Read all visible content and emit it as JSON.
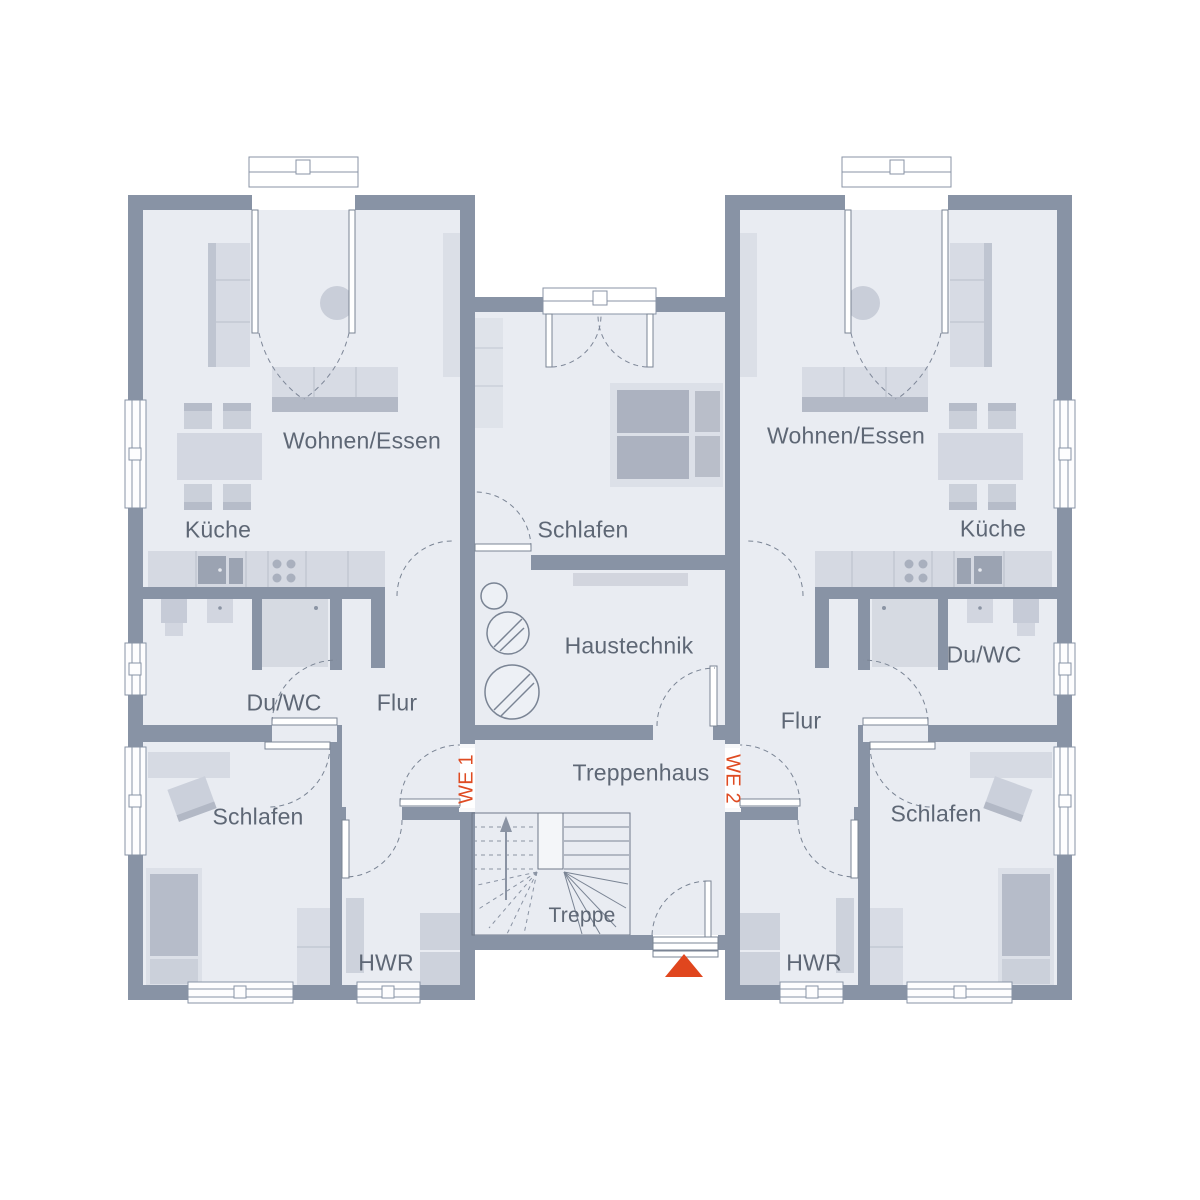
{
  "we1": {
    "label": "WE 1",
    "rooms": {
      "living": "Wohnen/Essen",
      "kitchen": "Küche",
      "bath": "Du/WC",
      "hall": "Flur",
      "bedroom": "Schlafen",
      "utility": "HWR"
    }
  },
  "we2": {
    "label": "WE 2",
    "rooms": {
      "living": "Wohnen/Essen",
      "kitchen": "Küche",
      "bath": "Du/WC",
      "hall": "Flur",
      "bedroom": "Schlafen",
      "utility": "HWR"
    }
  },
  "shared": {
    "bedroom": "Schlafen",
    "tech": "Haustechnik",
    "stairhall": "Treppenhaus",
    "stairs": "Treppe"
  },
  "colors": {
    "wall": "#8893A5",
    "floor": "#E9ECF2",
    "furniture_light": "#D7DBE4",
    "furniture_mid": "#C7CCD7",
    "furniture_dark": "#B2B8C5",
    "appliance": "#9BA3B2",
    "accent_orange": "#DF4B22",
    "label_text": "#5E6775",
    "outline": "#7A8494"
  }
}
